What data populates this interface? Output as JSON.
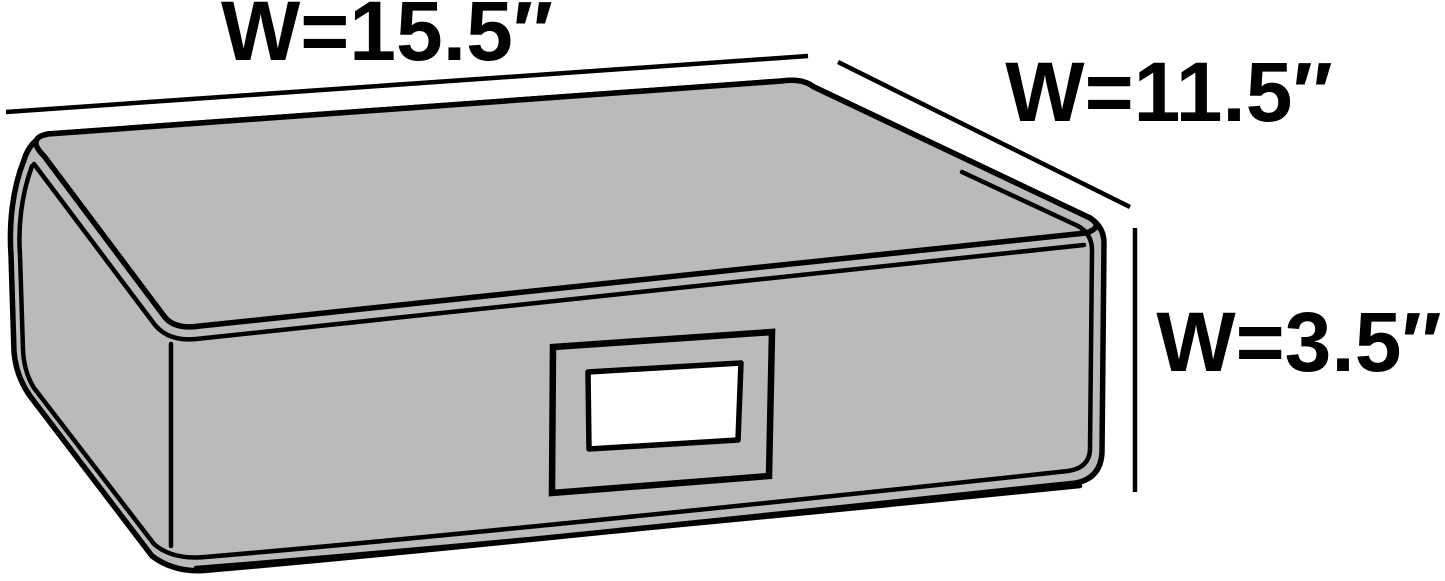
{
  "colors": {
    "background": "#ffffff",
    "box_fill": "#bababa",
    "outline": "#000000",
    "label_window": "#ffffff",
    "text": "#000000"
  },
  "dimensions": {
    "top_width_label": "W=15.5″",
    "side_width_label": "W=11.5″",
    "height_label": "W=3.5″"
  }
}
